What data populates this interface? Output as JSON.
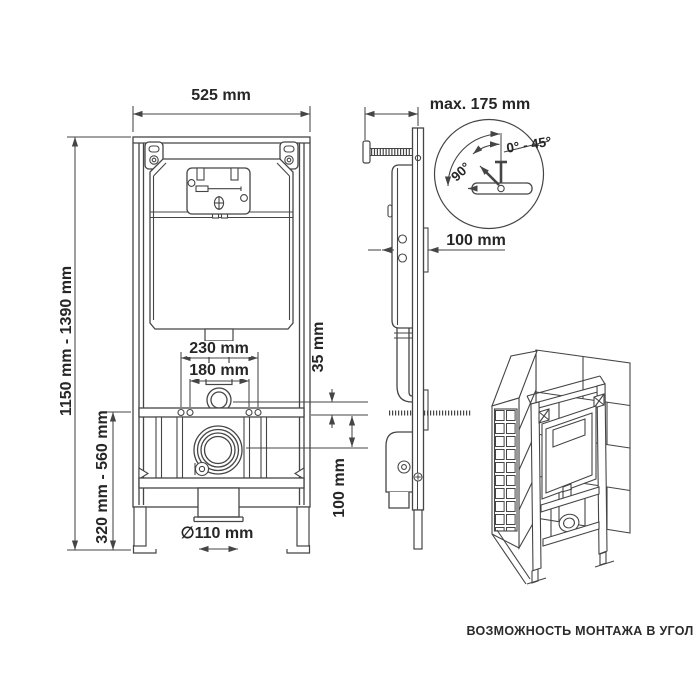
{
  "colors": {
    "line": "#454545",
    "text": "#262626",
    "background": "#ffffff"
  },
  "front_view": {
    "width": "525 mm",
    "height_range": "1150 mm - 1390 mm",
    "lower_height_range": "320 mm - 560 mm",
    "fixing_spacing_outer": "230 mm",
    "fixing_spacing_inner": "180 mm",
    "flush_pipe_offset": "35 mm",
    "outlet_center_drop": "100 mm",
    "outlet_diameter": "∅110 mm"
  },
  "side_view": {
    "wall_distance_max": "max. 175 mm",
    "frame_depth": "100 mm"
  },
  "detail_view": {
    "bracket_angle": "90°",
    "rotation_range": "0° - 45°"
  },
  "corner_view": {
    "caption": "ВОЗМОЖНОСТЬ МОНТАЖА В УГОЛ"
  }
}
